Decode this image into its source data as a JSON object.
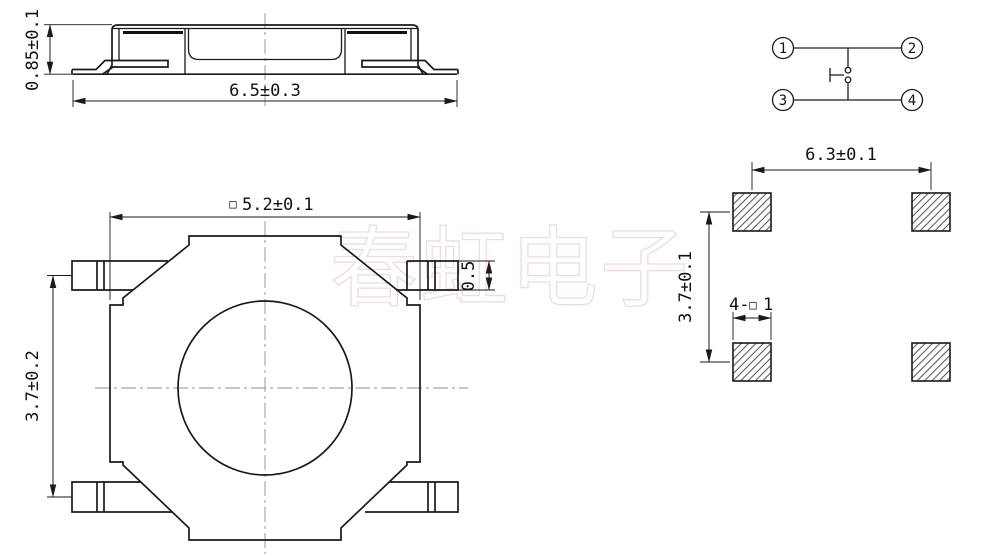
{
  "watermark": {
    "text": "春虹电子",
    "color": "#eedcdc"
  },
  "views": {
    "side": {
      "width_dim": "6.5±0.3",
      "height_dim": "0.85±0.1"
    },
    "top": {
      "square_symbol": "□",
      "width_dim": "5.2±0.1",
      "lead_row_pitch_dim": "3.7±0.2",
      "lead_width_dim": "0.5"
    },
    "circuit": {
      "terminals": [
        "1",
        "2",
        "3",
        "4"
      ]
    },
    "pcb": {
      "pad_pitch_x_dim": "6.3±0.1",
      "pad_pitch_y_dim": "3.7±0.1",
      "pad_count_prefix": "4-",
      "pad_square_symbol": "□",
      "pad_size_value": "1"
    }
  },
  "colors": {
    "line": "#1a1a1a",
    "centerline": "#8f8f8f",
    "watermark_stroke": "#eedcdc"
  }
}
